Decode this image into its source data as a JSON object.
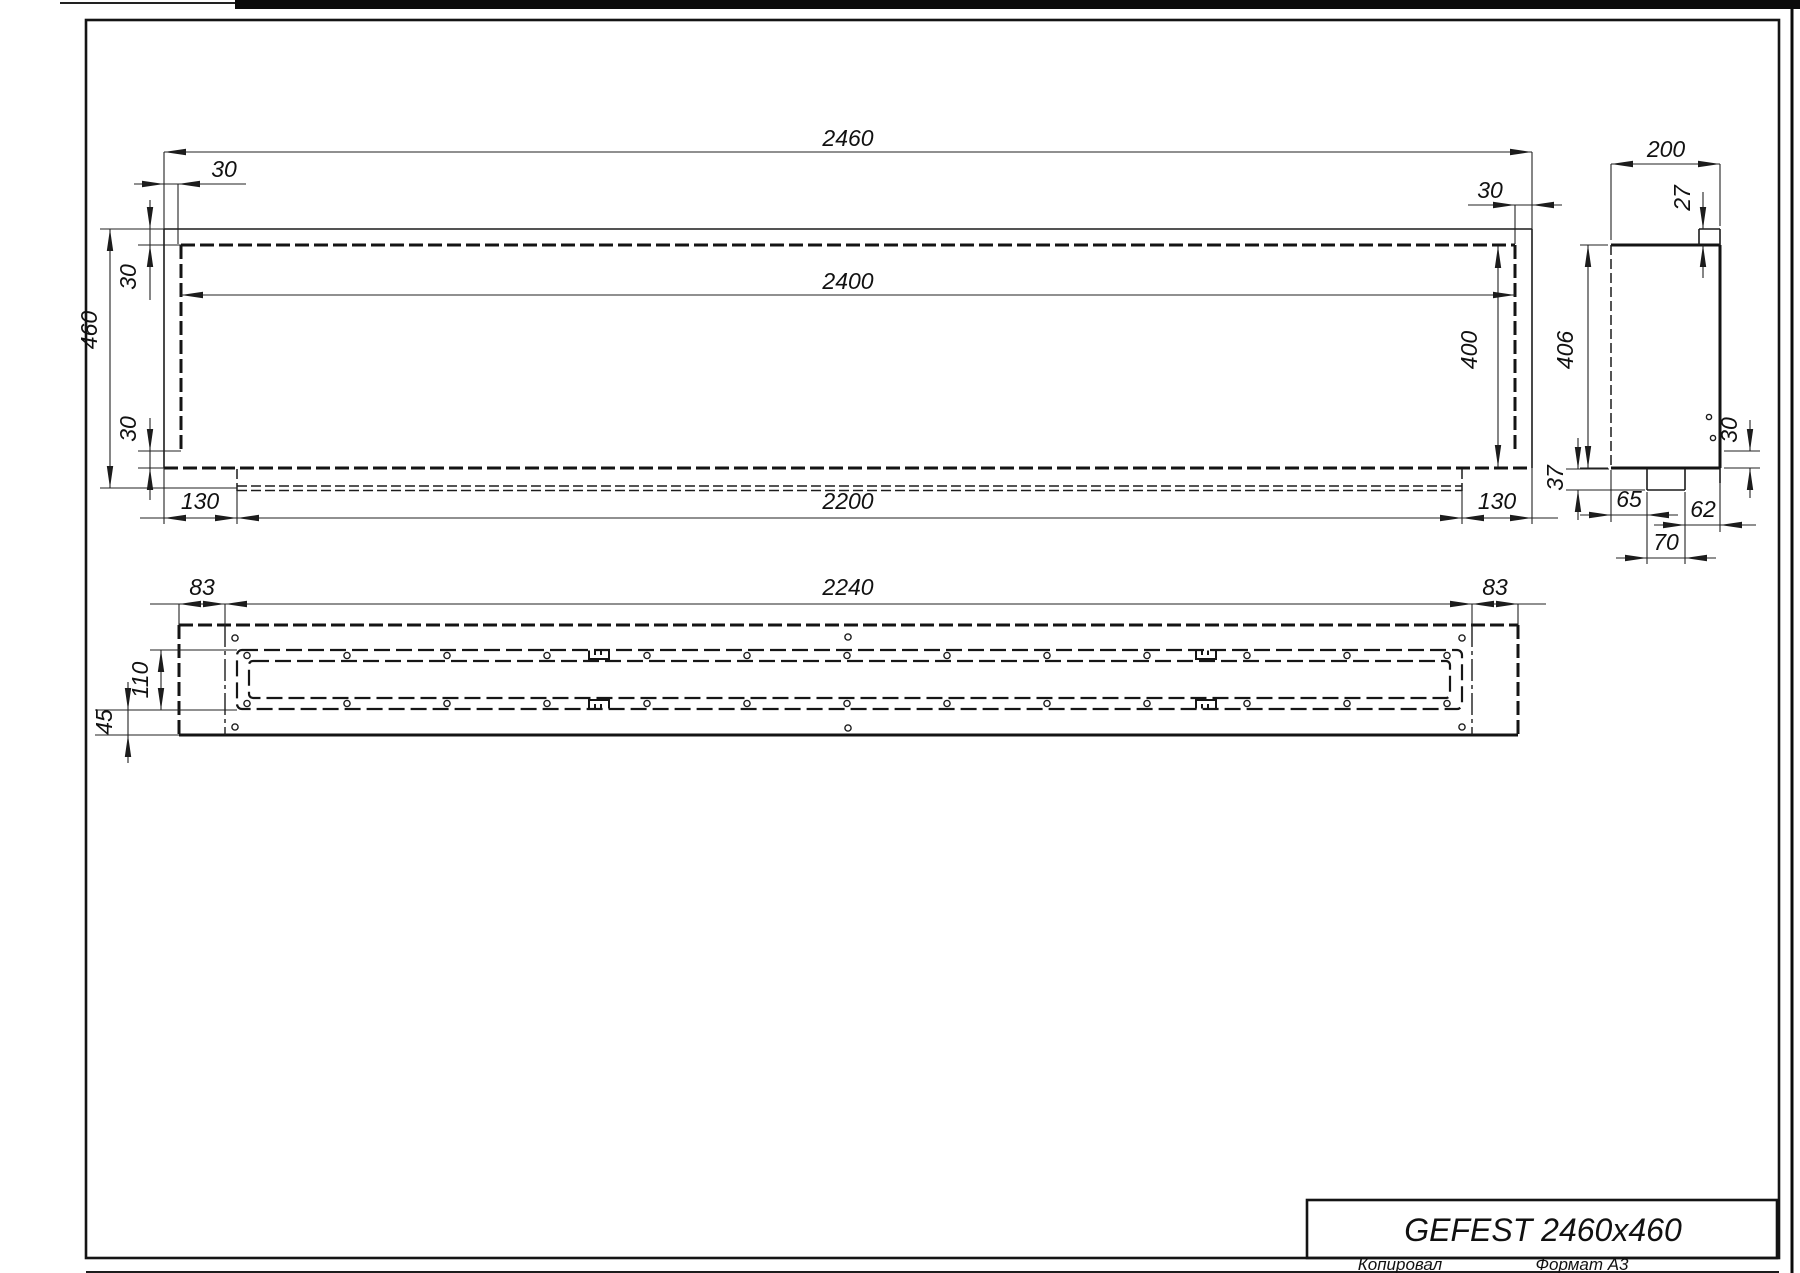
{
  "front_view": {
    "overall_width": "2460",
    "inner_width": "2400",
    "overall_height": "460",
    "top_inset": "30",
    "bottom_inset": "30",
    "left_inset": "30",
    "right_inset": "30",
    "inner_height": "400",
    "tray_width": "2200",
    "tray_left_offset": "130",
    "tray_right_offset": "130"
  },
  "side_view": {
    "depth": "200",
    "top_lip": "27",
    "body_height": "406",
    "bottom_flange": "37",
    "hole_offset": "30",
    "bottom_seg_left": "65",
    "bottom_seg_mid": "70",
    "bottom_seg_right": "62"
  },
  "bottom_view": {
    "insert_width": "2240",
    "left_margin": "83",
    "right_margin": "83",
    "burner_depth": "110",
    "flange_depth": "45"
  },
  "title_block": {
    "model": "GEFEST 2460x460"
  },
  "footer": {
    "copied": "Копировал",
    "format": "Формат А3"
  }
}
